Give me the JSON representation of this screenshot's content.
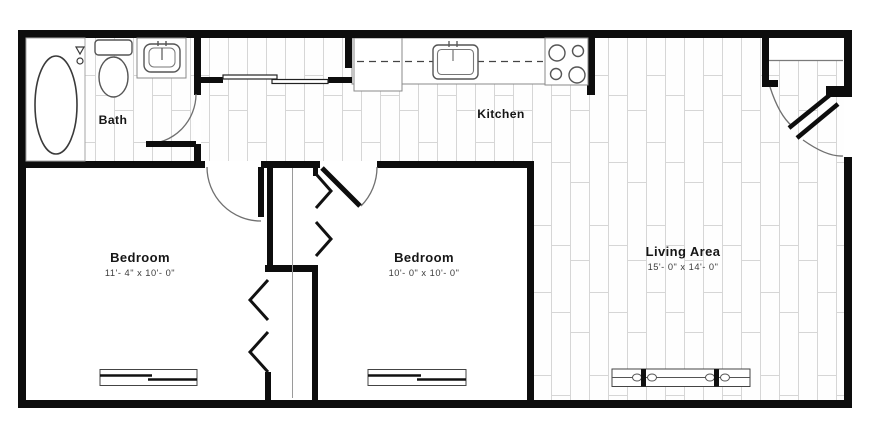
{
  "plan": {
    "title": "Floor plan",
    "rooms": [
      {
        "id": "bath",
        "label": "Bath",
        "dims": ""
      },
      {
        "id": "kitchen",
        "label": "Kitchen",
        "dims": ""
      },
      {
        "id": "bedroom1",
        "label": "Bedroom",
        "dims": "11'- 4\" x 10'- 0\""
      },
      {
        "id": "bedroom2",
        "label": "Bedroom",
        "dims": "10'- 0\" x 10'- 0\""
      },
      {
        "id": "living",
        "label": "Living Area",
        "dims": "15'- 0\" x 14'- 0\""
      }
    ],
    "fixtures": [
      {
        "icon": "bathtub-icon"
      },
      {
        "icon": "toilet-icon"
      },
      {
        "icon": "bath-sink-icon"
      },
      {
        "icon": "kitchen-sink-icon"
      },
      {
        "icon": "stove-icon"
      },
      {
        "icon": "refrigerator-icon"
      },
      {
        "icon": "window-glyph"
      },
      {
        "icon": "door-swing-glyph"
      },
      {
        "icon": "bifold-door-glyph"
      },
      {
        "icon": "sliding-door-glyph"
      }
    ],
    "colors": {
      "wall": "#0d0d0d",
      "fixture_line": "#555555",
      "plank_line": "#d6d6d6",
      "dim_text": "#3c3c3c",
      "background": "#ffffff"
    }
  }
}
